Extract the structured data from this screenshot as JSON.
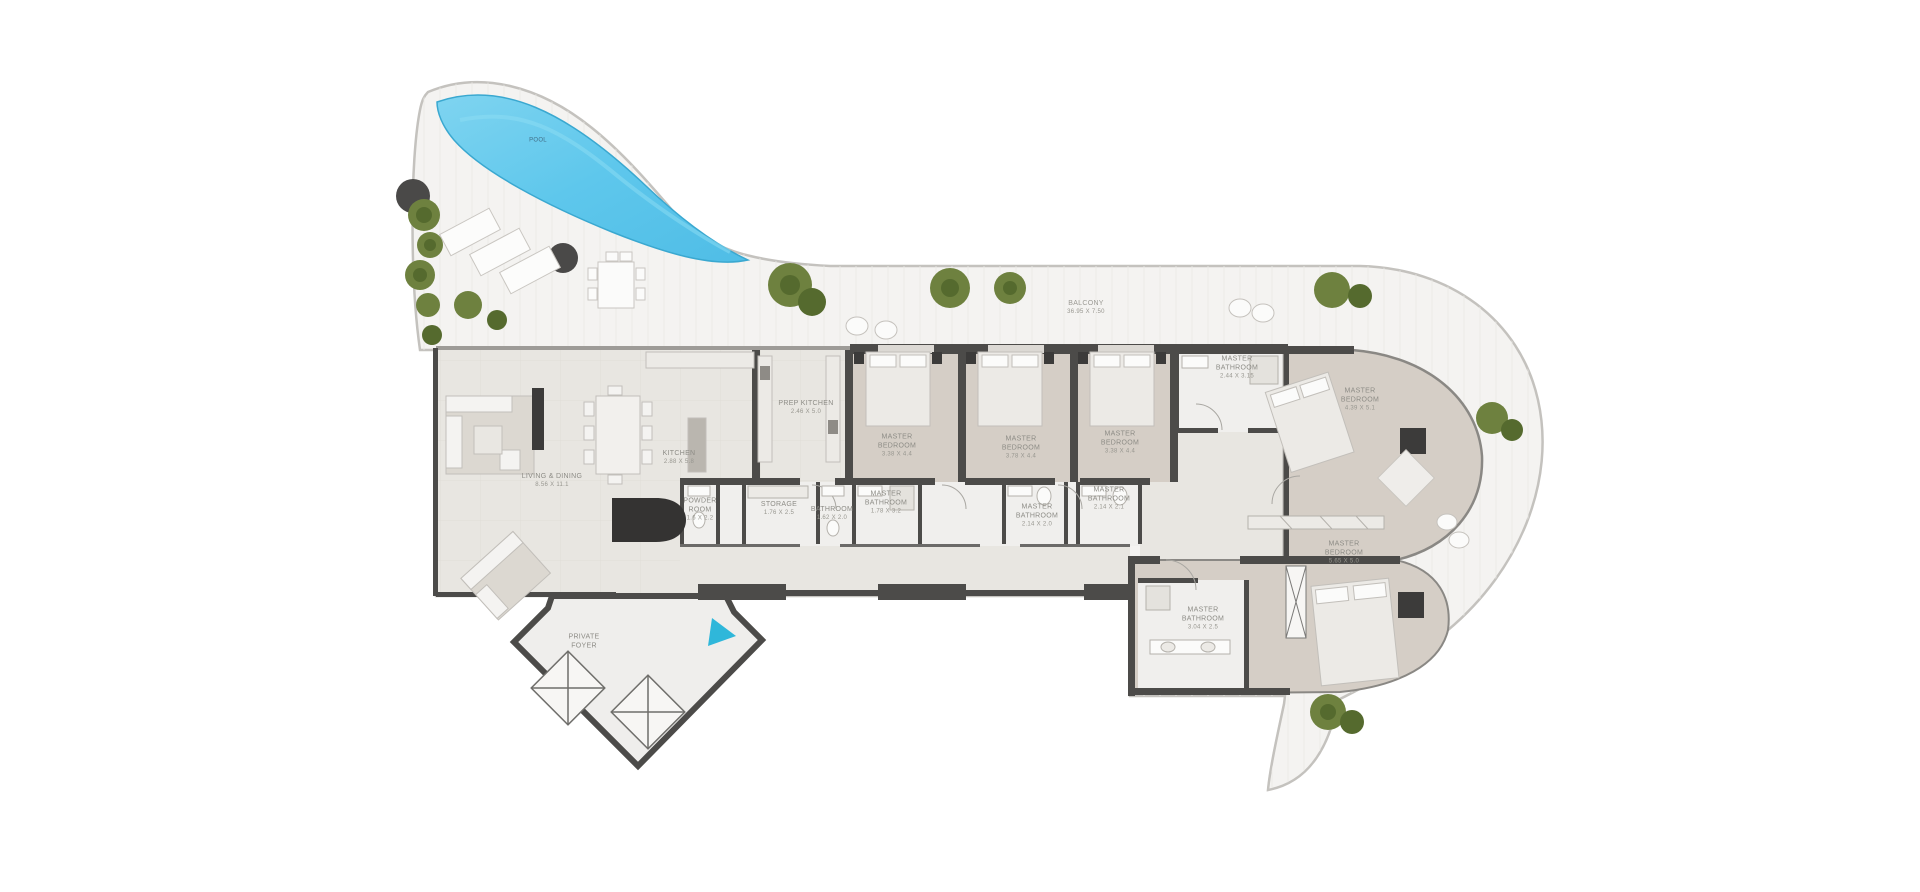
{
  "plan": {
    "type": "residential-floor-plan",
    "colors": {
      "pool": "#5ec7ec",
      "terrace_floor": "#f4f3f1",
      "interior_floor": "#e8e6e1",
      "bedroom_floor": "#d5cec6",
      "bathroom_floor": "#f0efed",
      "wall": "#4c4b49",
      "plant": "#6e813f",
      "marker_accent": "#2fb7da",
      "outline": "#c4c2be"
    },
    "pool_label": "POOL",
    "balcony": {
      "name": "BALCONY",
      "dims": "36.95 X 7.50"
    },
    "rooms": [
      {
        "id": "living-dining",
        "name": "LIVING & DINING",
        "dims": "8.56 X 11.1"
      },
      {
        "id": "kitchen",
        "name": "KITCHEN",
        "dims": "2.88 X 5.8"
      },
      {
        "id": "prep-kitchen",
        "name": "PREP KITCHEN",
        "dims": "2.46 X 5.0"
      },
      {
        "id": "master-bedroom-1",
        "name": "MASTER BEDROOM",
        "dims": "3.38 X 4.4"
      },
      {
        "id": "master-bedroom-2",
        "name": "MASTER BEDROOM",
        "dims": "3.78 X 4.4"
      },
      {
        "id": "master-bedroom-3",
        "name": "MASTER BEDROOM",
        "dims": "3.38 X 4.4"
      },
      {
        "id": "master-bathroom-top",
        "name": "MASTER BATHROOM",
        "dims": "2.44 X 3.15"
      },
      {
        "id": "master-bedroom-right",
        "name": "MASTER BEDROOM",
        "dims": "4.39 X 5.1"
      },
      {
        "id": "powder-room",
        "name": "POWDER ROOM",
        "dims": "1.6 X 2.2"
      },
      {
        "id": "storage",
        "name": "STORAGE",
        "dims": "1.76 X 2.5"
      },
      {
        "id": "bathroom",
        "name": "BATHROOM",
        "dims": "1.62 X 2.0"
      },
      {
        "id": "master-bathroom-a",
        "name": "MASTER BATHROOM",
        "dims": "1.78 X 3.2"
      },
      {
        "id": "master-bathroom-b",
        "name": "MASTER BATHROOM",
        "dims": "2.14 X 2.0"
      },
      {
        "id": "master-bathroom-c",
        "name": "MASTER BATHROOM",
        "dims": "2.14 X 2.1"
      },
      {
        "id": "master-bedroom-bottom",
        "name": "MASTER BEDROOM",
        "dims": "5.65 X 5.0"
      },
      {
        "id": "master-bathroom-bottom",
        "name": "MASTER BATHROOM",
        "dims": "3.04 X 2.5"
      },
      {
        "id": "private-foyer",
        "name": "PRIVATE FOYER",
        "dims": ""
      }
    ]
  }
}
